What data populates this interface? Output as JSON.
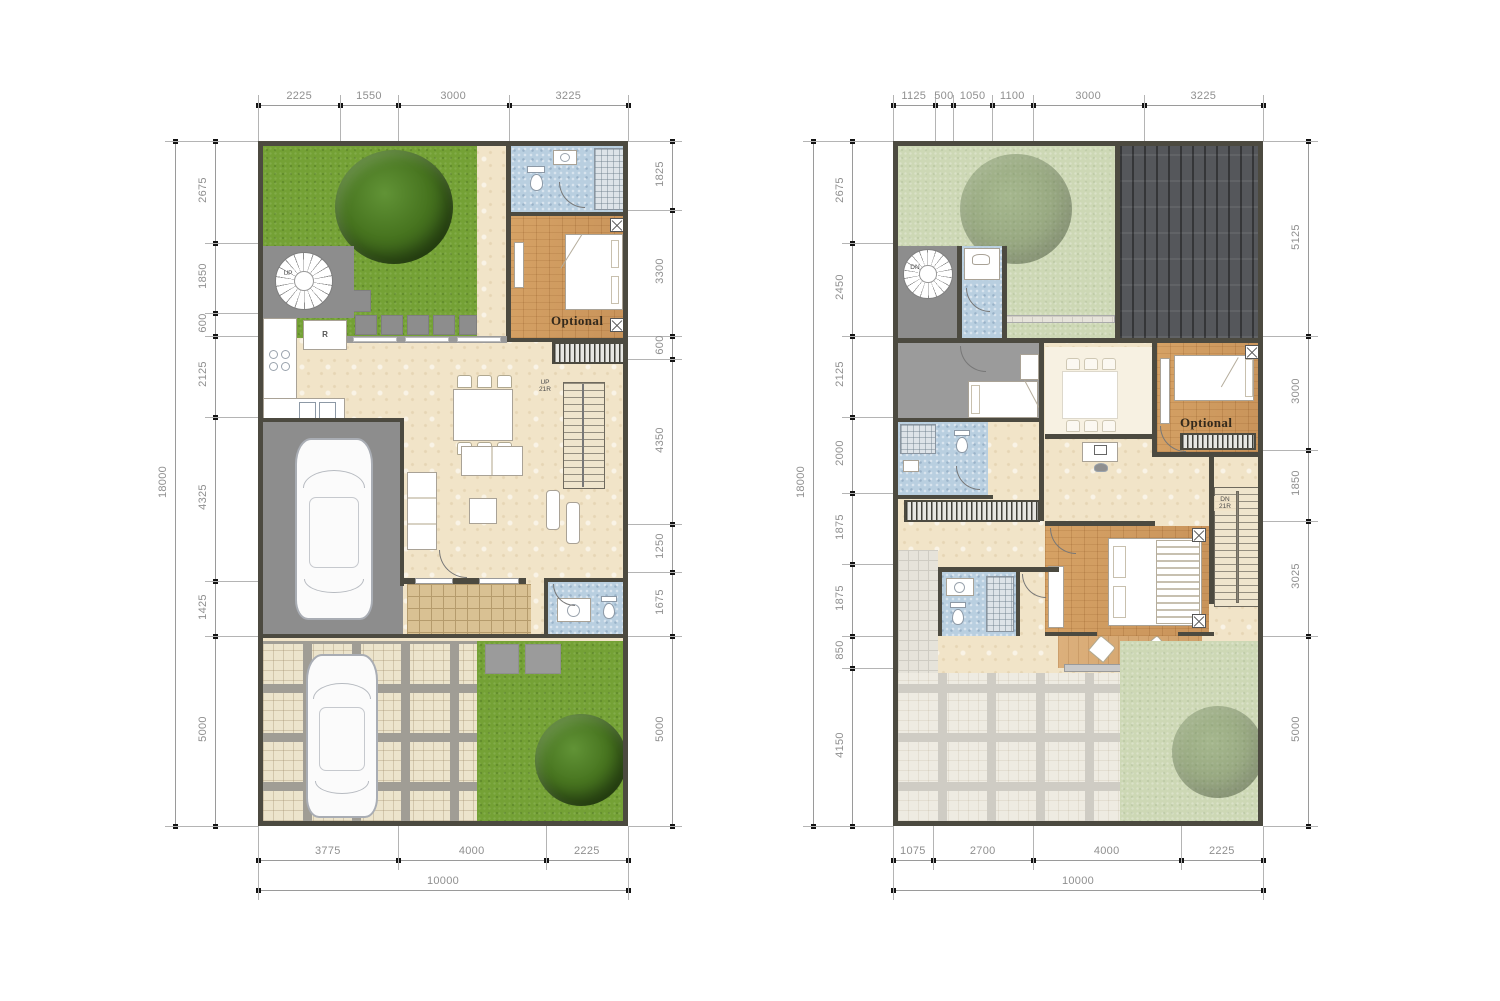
{
  "colors": {
    "wall": "#4c4a40",
    "grass": "#74a135",
    "grass_faded": "#cdd8b5",
    "roof": "#55575b",
    "bath_tile": "#b9cfe0",
    "wood_floor": "#cf9a60",
    "marble_floor": "#f1e4c8",
    "garage_gray": "#8d8d8d",
    "dim_text": "#8f8f8f",
    "dim_tick": "#141414"
  },
  "plans": [
    {
      "dims": {
        "top": [
          2225,
          1550,
          3000,
          3225
        ],
        "left": [
          2675,
          1850,
          600,
          2125,
          4325,
          1425,
          5000
        ],
        "left_total": 18000,
        "right": [
          1825,
          3300,
          600,
          4350,
          1250,
          1675,
          5000
        ],
        "bottom": [
          3775,
          4000,
          2225
        ],
        "bottom_total": 10000
      },
      "labels": {
        "optional": "Optional",
        "stair_direction": "UP",
        "stair_risers": "21R",
        "spiral_direction": "UP",
        "refrigerator": "R"
      }
    },
    {
      "dims": {
        "top": [
          1125,
          500,
          1050,
          1100,
          3000,
          3225
        ],
        "left": [
          2675,
          2450,
          2125,
          2000,
          1875,
          1875,
          850,
          4150
        ],
        "left_total": 18000,
        "right": [
          5125,
          3000,
          1850,
          3025,
          5000
        ],
        "bottom": [
          1075,
          2700,
          4000,
          2225
        ],
        "bottom_total": 10000
      },
      "labels": {
        "optional": "Optional",
        "stair_direction": "DN",
        "stair_risers": "21R",
        "spiral_direction": "DN"
      }
    }
  ]
}
